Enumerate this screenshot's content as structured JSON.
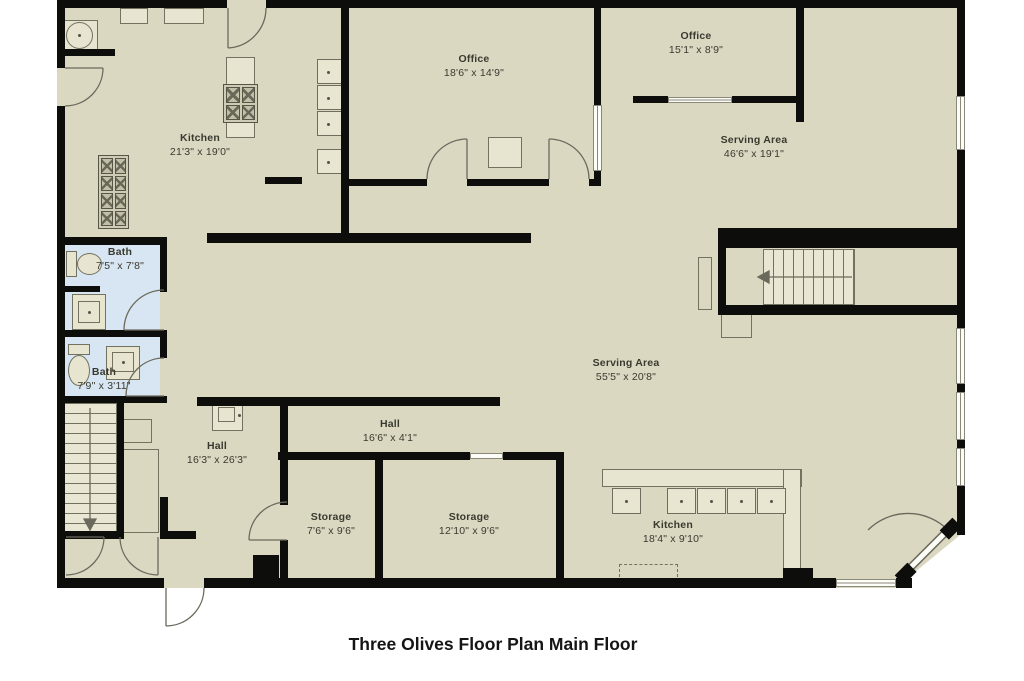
{
  "title": "Three Olives Floor Plan Main Floor",
  "rooms": {
    "kitchen_main": {
      "name": "Kitchen",
      "dims": "21'3\" x 19'0\""
    },
    "office_large": {
      "name": "Office",
      "dims": "18'6\" x 14'9\""
    },
    "office_small": {
      "name": "Office",
      "dims": "15'1\" x 8'9\""
    },
    "serving_upper": {
      "name": "Serving Area",
      "dims": "46'6\" x 19'1\""
    },
    "serving_main": {
      "name": "Serving Area",
      "dims": "55'5\" x 20'8\""
    },
    "bath_large": {
      "name": "Bath",
      "dims": "7'5\" x 7'8\""
    },
    "bath_small": {
      "name": "Bath",
      "dims": "7'9\" x 3'11\""
    },
    "hall_main": {
      "name": "Hall",
      "dims": "16'3\" x 26'3\""
    },
    "hall_narrow": {
      "name": "Hall",
      "dims": "16'6\" x 4'1\""
    },
    "storage_small": {
      "name": "Storage",
      "dims": "7'6\" x 9'6\""
    },
    "storage_large": {
      "name": "Storage",
      "dims": "12'10\" x 9'6\""
    },
    "kitchen_lower": {
      "name": "Kitchen",
      "dims": "18'4\" x 9'10\""
    }
  },
  "colors": {
    "floor": "#dbd8c2",
    "bath_floor": "#d7e6f2",
    "wall": "#0d0d0b",
    "fixture_outline": "#73715f"
  }
}
